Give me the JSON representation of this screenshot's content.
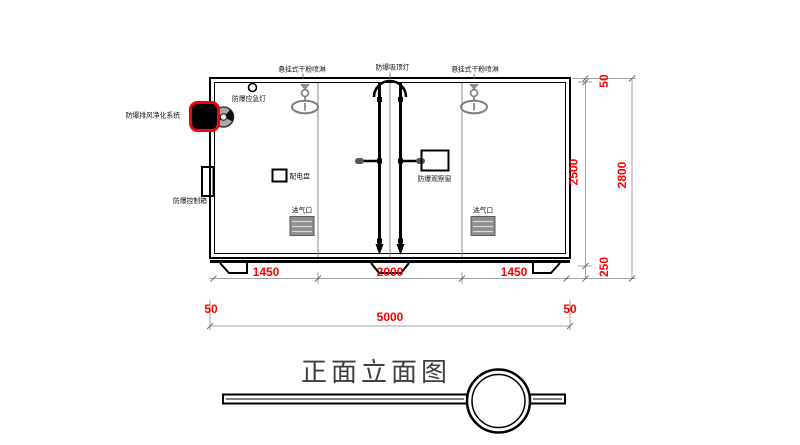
{
  "drawing": {
    "title": "正面立面图",
    "labels": {
      "sprinkler_left": "悬挂式干粉喷淋",
      "ceiling_light": "防爆吸顶灯",
      "sprinkler_right": "悬挂式干粉喷淋",
      "emergency_light": "防爆应急灯",
      "exhaust_purifier": "防爆排风净化系统",
      "control_box": "防爆控制箱",
      "power_panel": "配电盘",
      "observation_window": "防爆观察窗",
      "air_inlet_left": "进气口",
      "air_inlet_right": "进气口"
    },
    "dimensions": {
      "bottom_segments": [
        "1450",
        "2000",
        "1450"
      ],
      "bottom_total": [
        "50",
        "5000",
        "50"
      ],
      "right_segments": [
        "50",
        "2500",
        "250"
      ],
      "right_total": "2800"
    },
    "colors": {
      "line": "#000000",
      "dim_line": "#a3a3a3",
      "dim_text": "#ff0000",
      "accent_red": "#ff0000",
      "gray_fixture": "#8c8c8c",
      "vent_fill": "#8f8f8f",
      "title_text": "#3f3f3f"
    }
  }
}
